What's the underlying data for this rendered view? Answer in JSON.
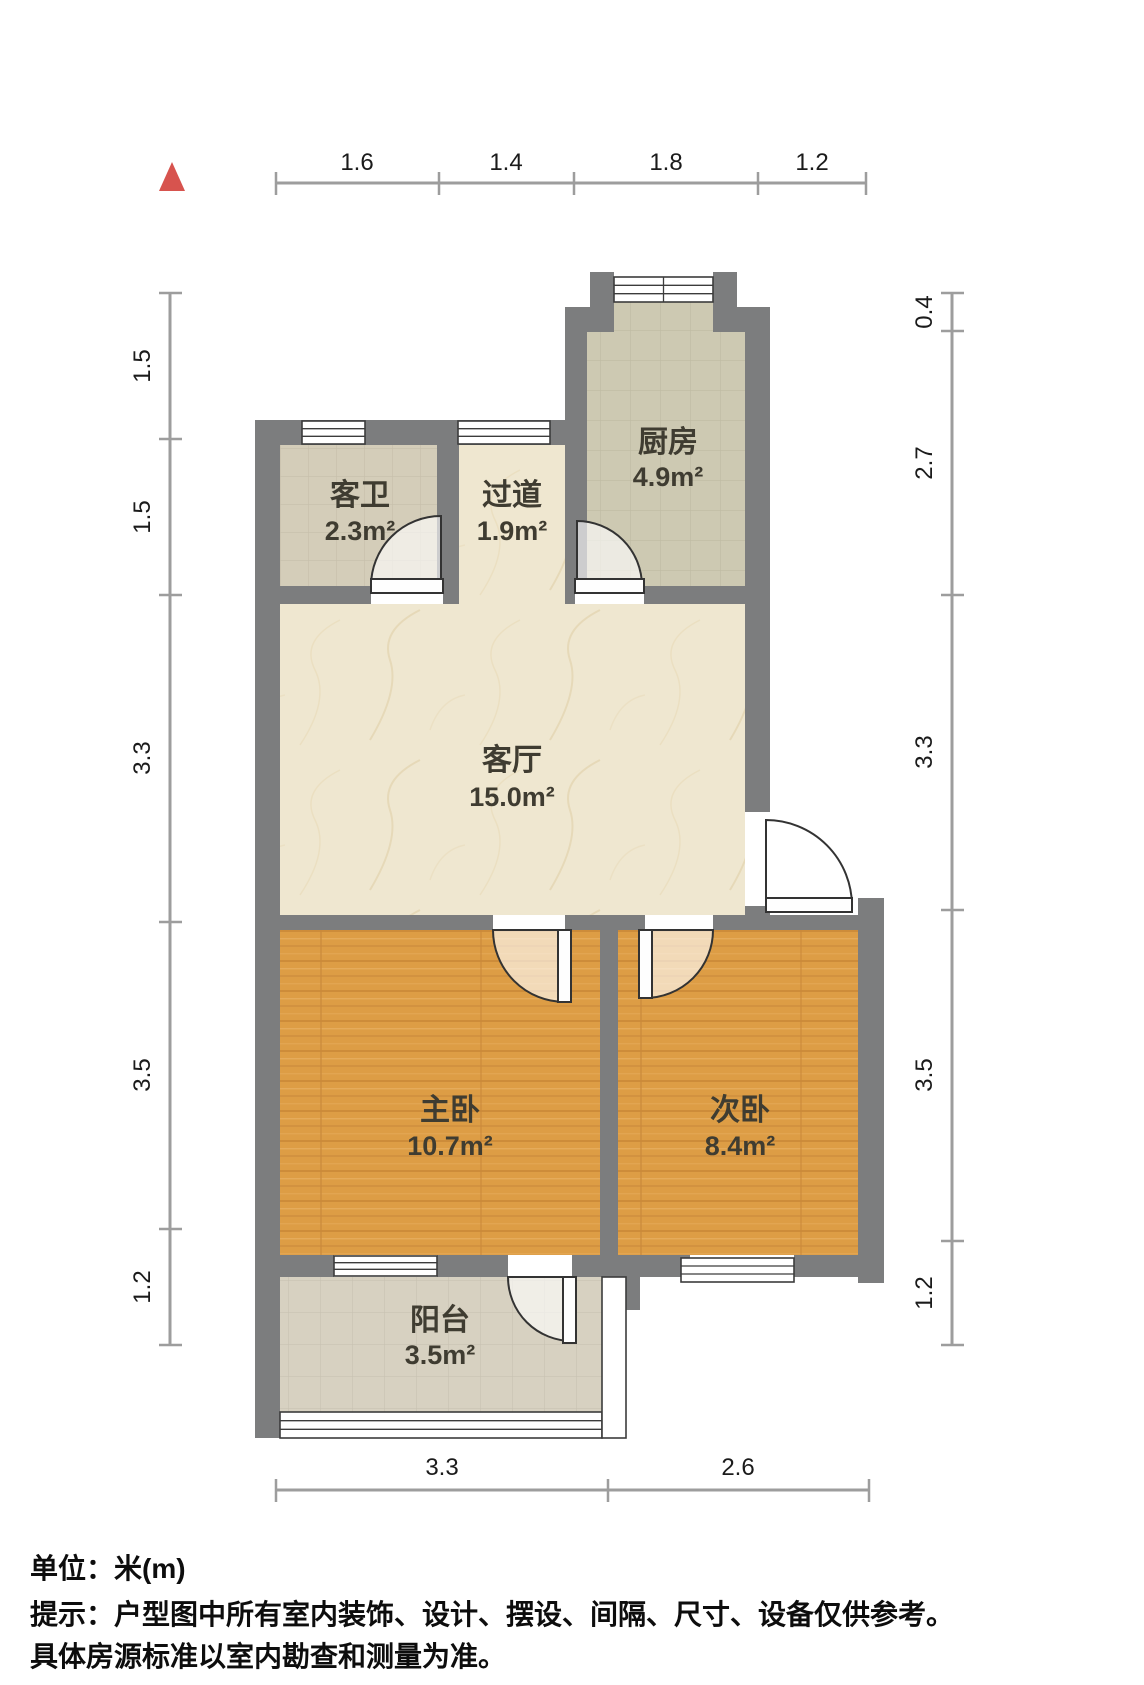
{
  "title": "户型图",
  "north_indicator": "north-arrow",
  "colors": {
    "wall": "#7c7d7e",
    "wood_floor": "#dd9d45",
    "marble_floor": "#efe7d0",
    "kitchen_tile": "#cdc9b2",
    "bath_tile": "#d4cdb9",
    "balcony_tile": "#d7d1c1",
    "north_arrow": "#d7534e",
    "dimension_line": "#9d9d9d"
  },
  "rooms": [
    {
      "id": "kitchen",
      "name": "厨房",
      "area": "4.9m²"
    },
    {
      "id": "guest-bathroom",
      "name": "客卫",
      "area": "2.3m²"
    },
    {
      "id": "hallway",
      "name": "过道",
      "area": "1.9m²"
    },
    {
      "id": "living-room",
      "name": "客厅",
      "area": "15.0m²"
    },
    {
      "id": "master-bedroom",
      "name": "主卧",
      "area": "10.7m²"
    },
    {
      "id": "second-bedroom",
      "name": "次卧",
      "area": "8.4m²"
    },
    {
      "id": "balcony",
      "name": "阳台",
      "area": "3.5m²"
    }
  ],
  "dimensions": {
    "unit": "m",
    "top": [
      "1.6",
      "1.4",
      "1.8",
      "1.2"
    ],
    "left": [
      "1.5",
      "1.5",
      "3.3",
      "3.5",
      "1.2"
    ],
    "right": [
      "0.4",
      "2.7",
      "3.3",
      "3.5",
      "1.2"
    ],
    "bottom": [
      "3.3",
      "2.6"
    ]
  },
  "footer": {
    "unit_note": "单位：米(m)",
    "tip_line1": "提示：户型图中所有室内装饰、设计、摆设、间隔、尺寸、设备仅供参考。",
    "tip_line2": "具体房源标准以室内勘查和测量为准。"
  }
}
